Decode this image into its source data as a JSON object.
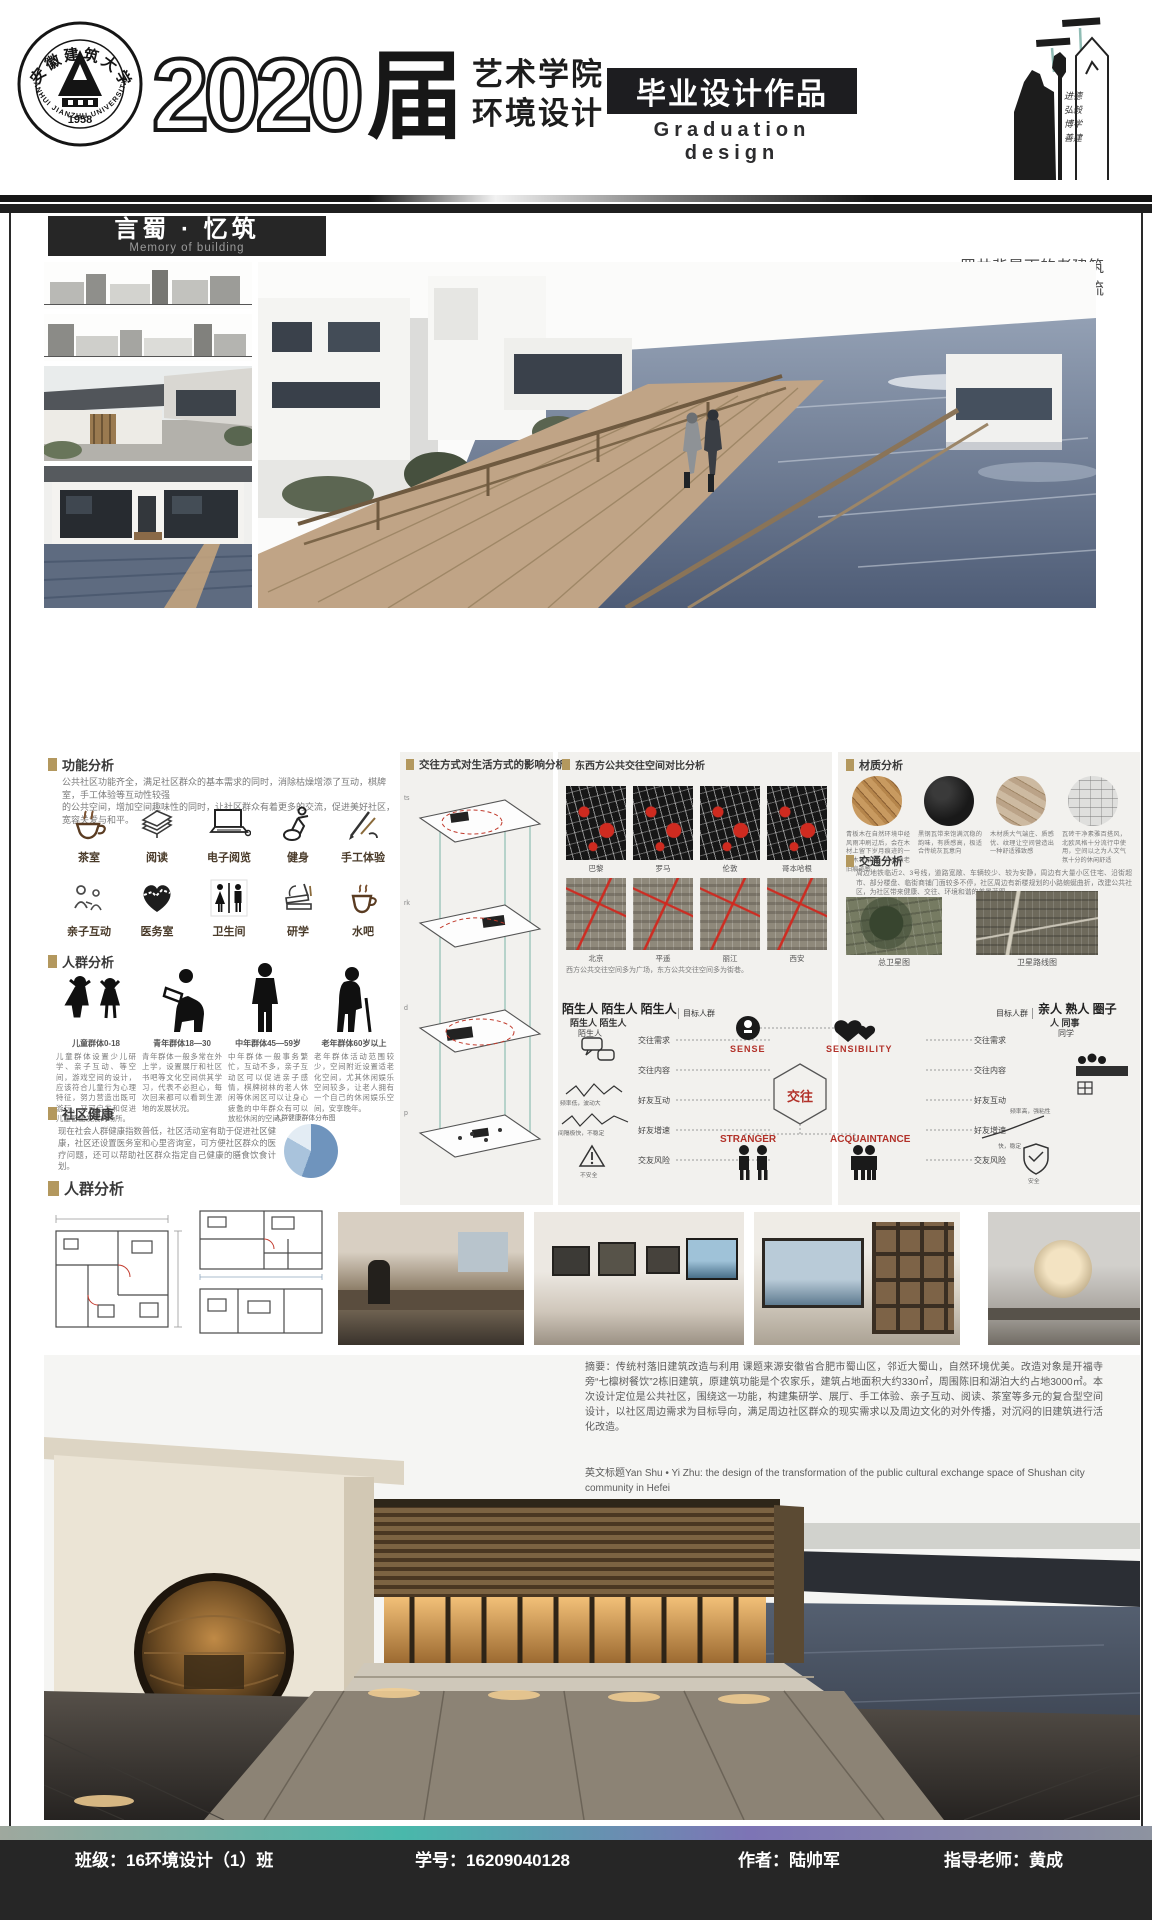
{
  "header": {
    "university_seal_top": "安徽建筑大学",
    "university_seal_bottom": "ANHUI JIANZHU UNIVERSITY",
    "university_seal_year": "1958",
    "batch_number": "2020",
    "batch_suffix": "届",
    "dept_line1": "艺术学院",
    "dept_line2": "环境设计",
    "banner": "毕业设计作品",
    "banner_en": "Graduation design",
    "motto": {
      "m1": "进德",
      "m2": "弘毅",
      "m3": "博学",
      "m4": "善建"
    }
  },
  "title_block": {
    "title": "言蜀 · 忆筑",
    "title_en": "Memory of building",
    "tagline1": "蜀井背景下的老建筑",
    "tagline2": "空间改造设计--合肥蜀山城市社区公共文化交流"
  },
  "function": {
    "heading": "功能分析",
    "desc1": "公共社区功能齐全，满足社区群众的基本需求的同时，消除枯燥增添了互动，棋牌室，手工体验等互动性较强",
    "desc2": "的公共空间，增加空间趣味性的同时，让社区群众有着更多的交流，促进美好社区，宽容关爱与和平。",
    "row1": [
      "茶室",
      "阅读",
      "电子阅览",
      "健身",
      "手工体验"
    ],
    "row2": [
      "亲子互动",
      "医务室",
      "卫生间",
      "研学",
      "水吧"
    ]
  },
  "crowd": {
    "heading": "人群分析",
    "groups": [
      {
        "label": "儿童群体0-18",
        "desc": "儿童群体设置少儿研学、亲子互动、等空间，游戏空间的设计，应该符合儿童行为心理特征，努力营造出既可游玩、又可启发和促进儿童智能发展的场所。"
      },
      {
        "label": "青年群体18—30",
        "desc": "青年群体一般多常在外上学，设置展厅和社区书吧等文化空间供其学习，代表不必担心，每次回来都可以看到生源地的发展状况。"
      },
      {
        "label": "中年群体45—59岁",
        "desc": "中年群体一般事务繁忙，互动不多，亲子互动区可以促进亲子感情，棋牌树林的老人休闲等休闲区可以让身心疲惫的中年群众有可以放松休闲的空间。"
      },
      {
        "label": "老年群体60岁以上",
        "desc": "老年群体活动范围较少，空间附近设置适老化空间，尤其休闲娱乐空间较多，让老人拥有一个自己的休闲娱乐空间，安享晚年。"
      }
    ]
  },
  "health": {
    "heading": "社区健康",
    "text": "现在社会人群健康指数普低，社区活动室有助于促进社区健康，社区还设置医务室和心里咨询室，可方便社区群众的医疗问题，还可以帮助社区群众指定自己健康的膳食饮食计划。",
    "pie_label": "人群健康群体分布图"
  },
  "plan": {
    "heading": "人群分析"
  },
  "interaction": {
    "heading": "交往方式对生活方式的影响分析",
    "layers": [
      "ts",
      "rk",
      "d",
      "p"
    ]
  },
  "compare": {
    "heading": "东西方公共交往空间对比分析",
    "west": [
      "巴黎",
      "罗马",
      "伦敦",
      "哥本哈根"
    ],
    "east": [
      "北京",
      "平遥",
      "丽江",
      "西安"
    ],
    "caption": "西方公共交往空间多为广场，东方公共交往空间多为街巷。"
  },
  "material": {
    "heading": "材质分析",
    "notes": [
      "青板木在自然环境中经风雨冲刷过后，会在木材上留下岁月痕迹的一个木材原色，有天然老旧痕迹感",
      "黑钢瓦带来饱满沉稳的韵味，有质感高，极适合传统灰瓦意向",
      "木材质大气端庄、质感优、纹理让空间营造出一种舒适雅致感",
      "瓦砖干净素雅百搭风，北欧风格十分流行中使用，空间以之为人文气氛十分的休闲舒适"
    ]
  },
  "traffic": {
    "heading": "交通分析",
    "text": "周边地铁临近2、3号线，道路宽敞、车辆较少、较为安静，周边有大量小区住宅、沿街超市、部分楼盘、临街商铺门面较多不停，社区周边有新楼规划的小路蜿蜒曲折，改建公共社区，为社区带来健康、交往、环境和谐的美景蓝图。",
    "map1": "总卫星图",
    "map2": "卫星路线图"
  },
  "diagram": {
    "left_cloud1": "陌生人 陌生人 陌生人",
    "left_cloud2": "陌生人 陌生人",
    "left_cloud3": "陌生人",
    "target_left": "目标人群",
    "target_right": "目标人群",
    "rows": [
      "交往需求",
      "交往内容",
      "好友互动",
      "好友增速",
      "交友风险"
    ],
    "left_note1": "频率低，波动大",
    "left_note2": "间隔极快，不稳定",
    "left_note3": "不安全",
    "right_note1": "频率高，强粘性",
    "right_note2": "快，稳定",
    "right_note3": "安全",
    "sense": "SENSE",
    "sensibility": "SENSIBILITY",
    "center": "交往",
    "stranger": "STRANGER",
    "acquaintance": "ACQUAINTANCE",
    "right_cloud1": "亲人 熟人 圈子",
    "right_cloud2": "人 同事",
    "right_cloud3": "同学"
  },
  "abstract": {
    "zh": "摘要：传统村落旧建筑改造与利用 课题来源安徽省合肥市蜀山区，邻近大蜀山，自然环境优美。改造对象是开福寺旁“七檩树餐饮”2栋旧建筑，原建筑功能是个农家乐，建筑占地面积大约330㎡，周围陈旧和湖泊大约占地3000㎡。本次设计定位是公共社区，围绕这一功能，构建集研学、展厅、手工体验、亲子互动、阅读、茶室等多元的复合型空间设计，以社区周边需求为目标导向，满足周边社区群众的现实需求以及周边文化的对外传播，对沉闷的旧建筑进行活化改造。",
    "en": "英文标题Yan Shu • Yi Zhu: the design of the transformation of the public cultural exchange space of Shushan city community in Hefei"
  },
  "footer": {
    "class_label": "班级：16环境设计（1）班",
    "student_id": "学号：16209040128",
    "author": "作者：陆帅军",
    "advisor": "指导老师：黄成"
  }
}
